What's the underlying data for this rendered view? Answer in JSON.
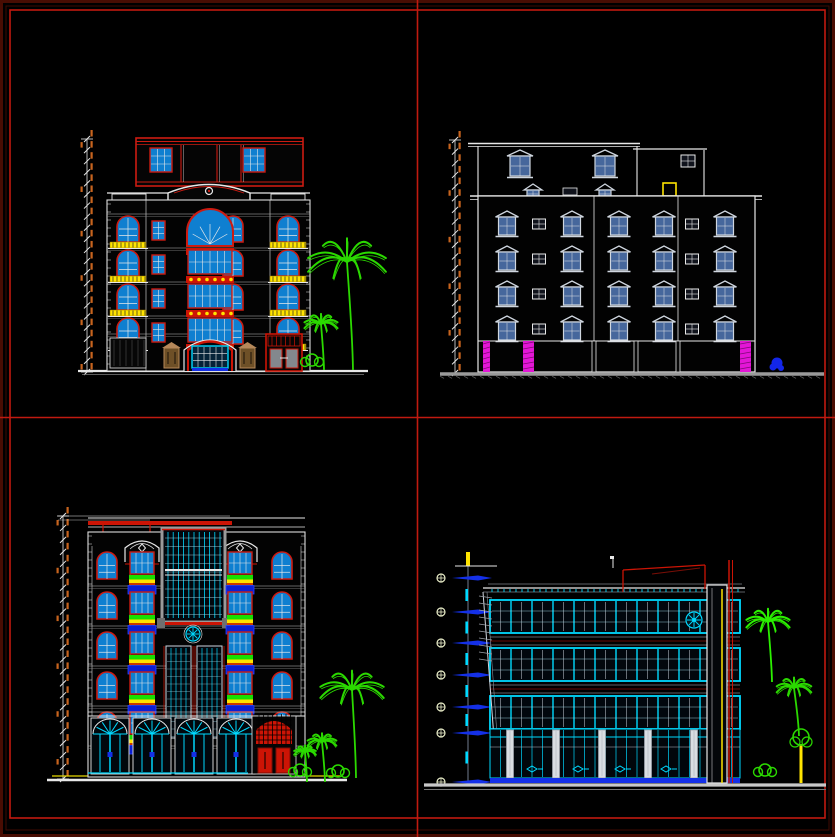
{
  "sheet": {
    "description": "CAD model-space sheet with four building elevation drawings separated by red layout grid lines",
    "background": "#000000",
    "border_outer_color": "#490d03",
    "border_inner_color": "#c01a10",
    "grid_line_color": "#c01a10"
  },
  "palette": {
    "red": "#cc1b11",
    "darkRed": "#7a0e06",
    "cyan": "#00d9ff",
    "blue": "#1430e8",
    "royal": "#0b1fd4",
    "yellow": "#ffe400",
    "orange": "#c8641e",
    "white": "#e8e8e8",
    "softWhite": "#cfd6df",
    "steel": "#46679c",
    "magenta": "#e316d6",
    "green": "#2bd900",
    "tan": "#b5885a",
    "gray": "#9a9a9a",
    "lightGray": "#c9c9c9",
    "glassBright": "#0f7fd0",
    "glassDark": "#02070d"
  },
  "panels": [
    {
      "name": "classical-front-elevation",
      "position": "top-left",
      "building": {
        "floors_above_ground": 4,
        "penthouse": true,
        "balconies": "yellow-railings",
        "entrance": "central-arched-glazed",
        "side_door": "red-double-door",
        "trees": 2
      },
      "geo": {
        "dim": {
          "x": 87,
          "y1": 139,
          "y2": 372,
          "ticks": 21
        },
        "ground": {
          "y": 371,
          "x1": 78,
          "x2": 368
        },
        "facade": {
          "x": 107,
          "y": 200,
          "w": 203,
          "h": 171
        },
        "pent": {
          "x": 136,
          "y": 138,
          "w": 167,
          "h": 48,
          "winXs": [
            150,
            243
          ],
          "winY": 148,
          "winW": 22,
          "winH": 24,
          "mull": [
            181,
            217,
            241
          ]
        },
        "parapet": {
          "y": 193,
          "pedX1": 168,
          "pedX2": 250,
          "ornX": 209,
          "ornY": 191
        },
        "rows": [
          216,
          250,
          284,
          318
        ],
        "cols": {
          "balcL": 128,
          "smallL": 158,
          "archR": 233,
          "balcR": 288,
          "centerX": 184,
          "centerW": 52
        },
        "groundY": 336,
        "lamps": [
          [
            164,
            348
          ],
          [
            240,
            348
          ]
        ],
        "redDoor": {
          "x": 266,
          "y": 334,
          "w": 36,
          "h": 37
        },
        "palms": {
          "big": [
            347,
            262,
            108
          ],
          "small": [
            321,
            324,
            46
          ]
        }
      }
    },
    {
      "name": "rear-elevation",
      "position": "top-right",
      "building": {
        "floors_above_ground": 4,
        "penthouse": true,
        "window_style": "pediment-top",
        "base_columns": "magenta-pilasters",
        "trees": 1
      },
      "geo": {
        "dim": {
          "x": 455,
          "y1": 140,
          "y2": 373,
          "ticks": 20
        },
        "roof": {
          "y": 143.5,
          "x1": 468,
          "x2": 640,
          "rx1": 633,
          "rx2": 707,
          "ry": 149
        },
        "body": {
          "x": 478,
          "y": 196,
          "x2": 755,
          "yb": 372
        },
        "divs": [
          594,
          678
        ],
        "rows": [
          211,
          246,
          281,
          316
        ],
        "pedCols": [
          507,
          572,
          619,
          664,
          725
        ],
        "sqCols": [
          539,
          692
        ],
        "pentWins": [
          520,
          605
        ],
        "pentSq": [
          688,
          155
        ],
        "miniPeds": [
          533,
          605
        ],
        "miniSq": [
          570,
          188
        ],
        "yellowDoor": [
          663,
          183,
          13,
          13
        ],
        "base": {
          "y": 341,
          "magenta": [
            [
              483,
              7
            ],
            [
              523,
              11
            ],
            [
              740,
              11
            ]
          ],
          "white": [
            594,
            636,
            678
          ]
        },
        "hatch": {
          "y": 374,
          "x1": 440,
          "x2": 824
        },
        "shrub": [
          777,
          363
        ]
      }
    },
    {
      "name": "ornate-front-elevation",
      "position": "bottom-left",
      "building": {
        "floors_above_ground": 5,
        "curtain_wall": "central-glazed",
        "balconies": "blue-boxes-with-planters",
        "storefront": "arched-bays",
        "entrance": "red-lattice-doors",
        "trees": 3
      },
      "geo": {
        "dim": {
          "x": 63,
          "y1": 516,
          "y2": 779,
          "ticks": 22
        },
        "groundYellow": {
          "y": 776,
          "x1": 52,
          "x2": 340
        },
        "ground": {
          "y": 780,
          "x1": 47,
          "x2": 347
        },
        "facade": {
          "x": 88,
          "y": 532,
          "w": 217,
          "h": 245
        },
        "roofBar": {
          "x": 88,
          "y": 521,
          "w": 144,
          "h": 4
        },
        "redDrops": [
          103,
          150
        ],
        "caps": [
          142,
          240
        ],
        "capY": 540,
        "center": {
          "x": 162,
          "y": 528,
          "w": 63,
          "h": 94
        },
        "rosette": [
          193,
          634
        ],
        "twin": {
          "xs": [
            166,
            197
          ],
          "y": 646,
          "w": 25,
          "h": 92
        },
        "rows": [
          552,
          592,
          632,
          672,
          712
        ],
        "outerCols": [
          107,
          282
        ],
        "innerCols": [
          142,
          240
        ],
        "floorLines": [
          586,
          626,
          666,
          706,
          746
        ],
        "shop": {
          "y": 716,
          "bays": [
            110,
            152,
            194,
            236
          ],
          "bayW": 38
        },
        "redEntr": {
          "x": 252,
          "y": 716,
          "w": 44,
          "h": 58
        },
        "palms": {
          "big": [
            352,
            690,
            88
          ],
          "s1": [
            322,
            742,
            40
          ],
          "s2": [
            305,
            752,
            30
          ]
        }
      }
    },
    {
      "name": "modern-glass-elevation",
      "position": "bottom-right",
      "building": {
        "floors_above_ground": 4,
        "facade": "cyan-curtain-wall",
        "level_markers": 7,
        "roof_feature": "red-pergola",
        "trees": 3
      },
      "geo": {
        "markers": {
          "cx": 441,
          "lineX": 468,
          "y1": 566,
          "y2": 783,
          "ys": [
            578,
            612,
            643,
            675,
            707,
            733,
            782
          ]
        },
        "topBar": {
          "x": 466,
          "y": 552,
          "h": 14
        },
        "roof": {
          "x1": 483,
          "x2": 745,
          "y": 588
        },
        "pergola": {
          "x1": 623,
          "x2": 705,
          "yTop": 566,
          "yBot": 592
        },
        "bands": [
          600,
          648,
          696
        ],
        "bandH": 33,
        "bandX": 490,
        "bandW": 250,
        "groundFloor": {
          "y": 729,
          "h": 49,
          "cols": [
            510,
            556,
            602,
            648,
            694
          ],
          "baseY": 778
        },
        "doorArrows": [
          532,
          578,
          620,
          666
        ],
        "tower": {
          "x": 707,
          "w": 20,
          "y": 585
        },
        "yellowLineX": 722,
        "redLines": [
          729,
          732.5
        ],
        "rosette": [
          694,
          620
        ],
        "groundLine": {
          "y": 785,
          "x1": 424,
          "x2": 826
        },
        "palms": {
          "p1": [
            768,
            622,
            60
          ],
          "p2": [
            794,
            688,
            48
          ],
          "bush": [
            765,
            770
          ],
          "ytree": [
            801,
            744
          ]
        }
      }
    }
  ]
}
